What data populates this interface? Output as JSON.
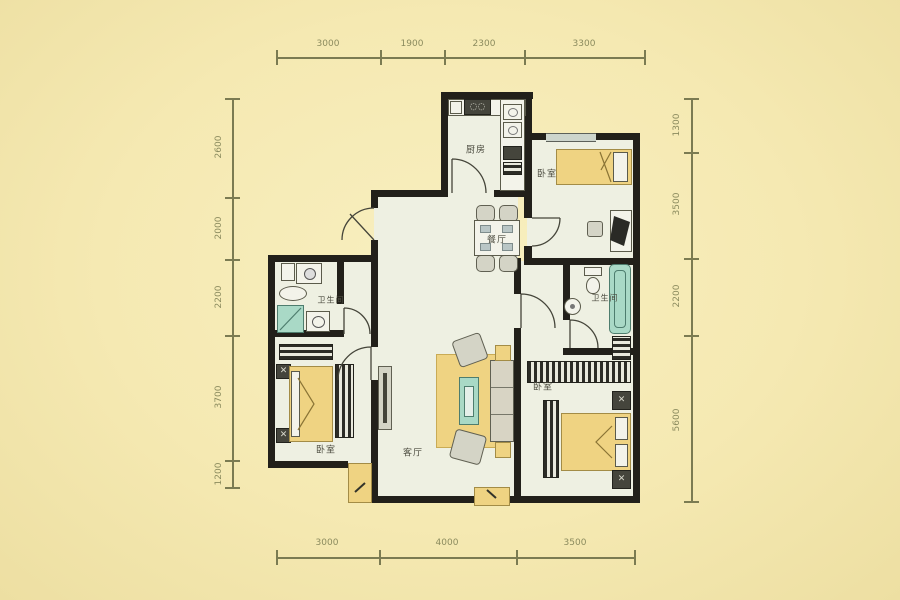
{
  "plan": {
    "rooms": {
      "kitchen": "厨房",
      "bedroom_top_right": "卧室",
      "dining": "餐厅",
      "bathroom_right": "卫生间",
      "bathroom_left": "卫生间",
      "bedroom_left": "卧室",
      "living": "客厅",
      "bedroom_bottom_right": "卧室"
    },
    "dimensions": {
      "top": [
        "3000",
        "1900",
        "2300",
        "3300"
      ],
      "bottom": [
        "3000",
        "4000",
        "3500"
      ],
      "left": [
        "2600",
        "2000",
        "2200",
        "3700",
        "1200"
      ],
      "right": [
        "1300",
        "3500",
        "2200",
        "5600"
      ]
    },
    "colors": {
      "background": "#f5e9b2",
      "wall": "#22201a",
      "floor": "#eef0e2",
      "furniture_yellow": "#efd382",
      "furniture_teal": "#a9d9c6",
      "dimension_line": "#7b7b52"
    }
  }
}
